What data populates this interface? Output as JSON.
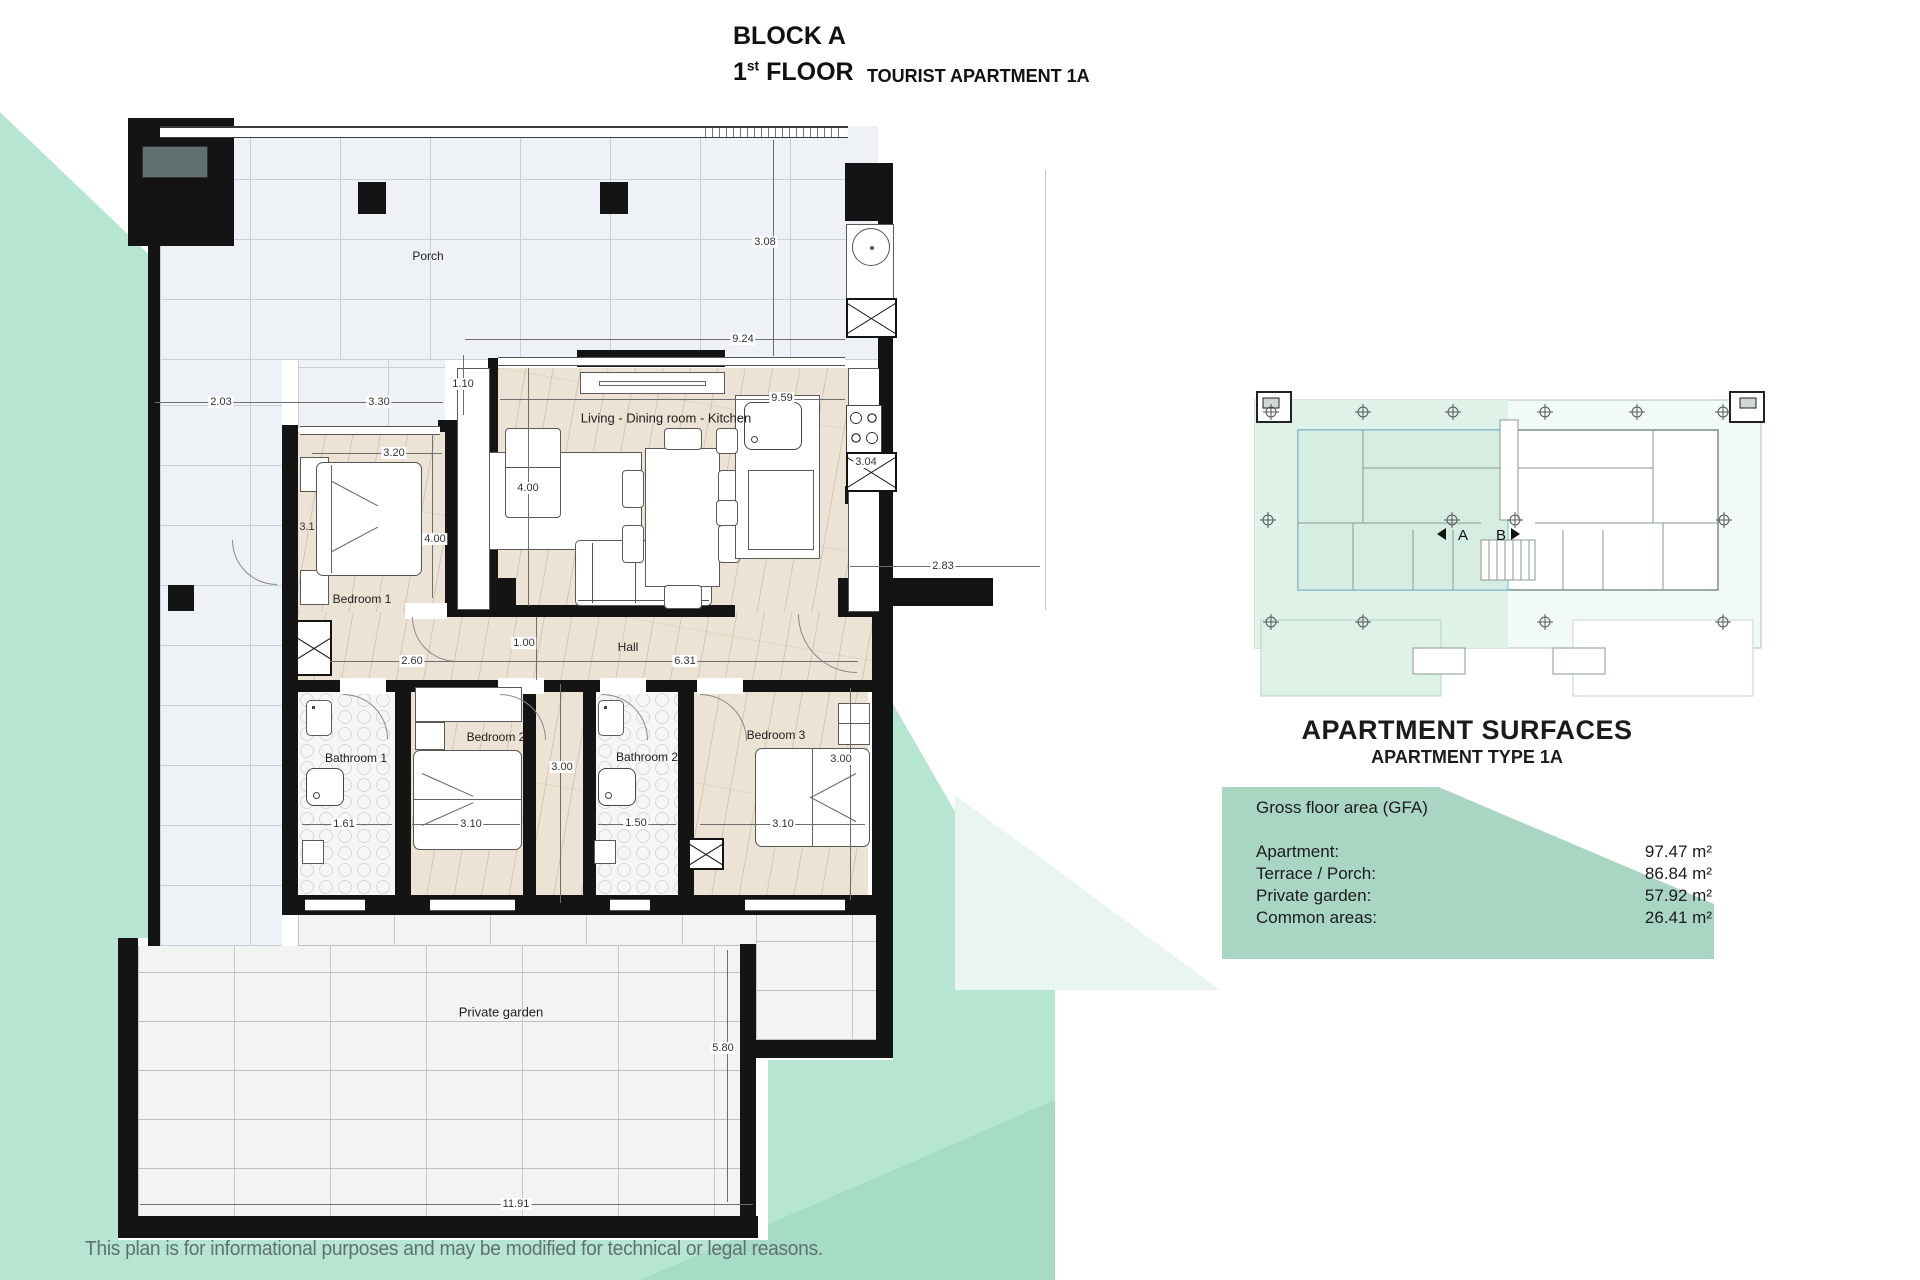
{
  "title": {
    "block": "BLOCK A",
    "floor_number": "1",
    "floor_ordinal": "st",
    "floor_word": "FLOOR",
    "apartment_type": "TOURIST APARTMENT 1A"
  },
  "rooms": {
    "porch": "Porch",
    "living": "Living - Dining room - Kitchen",
    "bedroom1": "Bedroom 1",
    "bedroom2": "Bedroom 2",
    "bedroom3": "Bedroom 3",
    "bathroom1": "Bathroom 1",
    "bathroom2": "Bathroom 2",
    "hall": "Hall",
    "garden": "Private garden"
  },
  "dims": {
    "d203": "2.03",
    "d330": "3.30",
    "d110": "1.10",
    "d924": "9.24",
    "d308": "3.08",
    "d959": "9.59",
    "d320": "3.20",
    "d400_living": "4.00",
    "d400_bed1": "4.00",
    "d31_bed1": "3.1",
    "d260": "2.60",
    "d100": "1.00",
    "d631": "6.31",
    "d283": "2.83",
    "d304": "3.04",
    "d300_hall": "3.00",
    "d300_bed3": "3.00",
    "d161": "1.61",
    "d310_bed2": "3.10",
    "d150": "1.50",
    "d310_bed3": "3.10",
    "d580": "5.80",
    "d1191": "11.91"
  },
  "overview": {
    "unit_a": "A",
    "unit_b": "B"
  },
  "surfaces": {
    "title": "APARTMENT SURFACES",
    "subtitle": "APARTMENT TYPE 1A",
    "gfa_label": "Gross floor area (GFA)",
    "rows": [
      {
        "label": "Apartment:",
        "value": "97.47 m²"
      },
      {
        "label": "Terrace / Porch:",
        "value": "86.84 m²"
      },
      {
        "label": "Private garden:",
        "value": "57.92 m²"
      },
      {
        "label": "Common areas:",
        "value": "26.41 m²"
      }
    ]
  },
  "footer": {
    "disclaimer": "This plan is for informational purposes and may be modified for technical or legal reasons."
  },
  "colors": {
    "mint": "#b6e6d1",
    "mint_dark": "#a6dcc5",
    "panel_green": "#a9d5c3",
    "wall": "#141414"
  }
}
